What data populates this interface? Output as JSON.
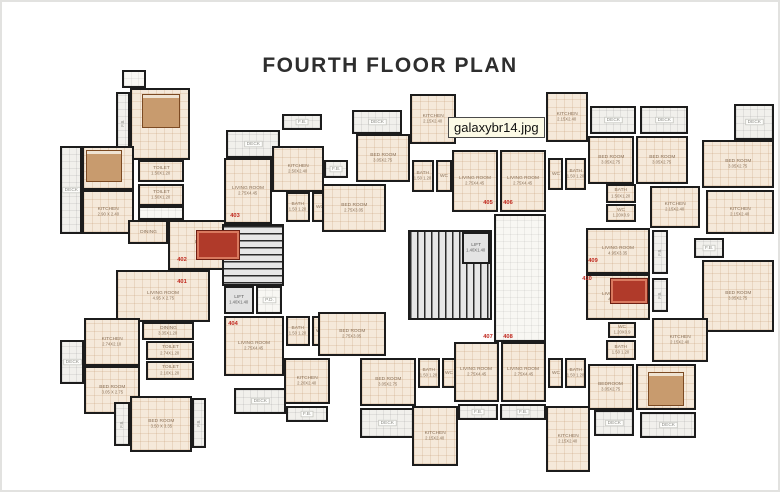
{
  "title": "FOURTH FLOOR PLAN",
  "filename_label": "galaxybr14.jpg",
  "colors": {
    "wall": "#1c1c1c",
    "room_fill": "#f5e9da",
    "deck_fill": "#f1f0ec",
    "stair_fill": "#e6e6e6",
    "flat_number_red": "#c0281e",
    "room_label": "#8a7158",
    "title_color": "#2e2e2e",
    "filename_bg": "#fcfae6"
  },
  "rooms": [
    {
      "id": "left-top-box",
      "label": "",
      "dims": "",
      "x": 122,
      "y": 70,
      "w": 24,
      "h": 18,
      "kind": "lobby"
    },
    {
      "id": "left-bedroom-top",
      "label": "BED ROOM",
      "dims": "3.50 X 3.35",
      "x": 130,
      "y": 88,
      "w": 60,
      "h": 72,
      "kind": "room"
    },
    {
      "id": "left-fb-top",
      "label": "F.B.",
      "dims": "",
      "x": 116,
      "y": 92,
      "w": 14,
      "h": 62,
      "kind": "deck",
      "rot": 1
    },
    {
      "id": "left-bedroom-west",
      "label": "BED ROOM",
      "dims": "2.90 X 2.5",
      "x": 82,
      "y": 146,
      "w": 52,
      "h": 44,
      "kind": "room"
    },
    {
      "id": "left-deck-west",
      "label": "DECK",
      "dims": "",
      "x": 60,
      "y": 146,
      "w": 22,
      "h": 88,
      "kind": "deck"
    },
    {
      "id": "left-kitchen-402",
      "label": "KITCHEN",
      "dims": "2.90 X 2.40",
      "x": 82,
      "y": 190,
      "w": 52,
      "h": 44,
      "kind": "room"
    },
    {
      "id": "left-toilet-1",
      "label": "TOILET",
      "dims": "1.50X1.20",
      "x": 138,
      "y": 160,
      "w": 46,
      "h": 22,
      "kind": "room"
    },
    {
      "id": "left-toilet-2",
      "label": "TOILET",
      "dims": "1.50X1.20",
      "x": 138,
      "y": 184,
      "w": 46,
      "h": 22,
      "kind": "room"
    },
    {
      "id": "left-passage",
      "label": "",
      "dims": "",
      "x": 138,
      "y": 206,
      "w": 46,
      "h": 14,
      "kind": "lobby"
    },
    {
      "id": "left-dining-402",
      "label": "DINING",
      "dims": "",
      "x": 128,
      "y": 220,
      "w": 40,
      "h": 24,
      "kind": "room"
    },
    {
      "id": "left-living-402",
      "label": "LIVINGROOM",
      "dims": "4.95X2.75",
      "x": 168,
      "y": 220,
      "w": 84,
      "h": 50,
      "kind": "room"
    },
    {
      "id": "left-living-401",
      "label": "LIVING ROOM",
      "dims": "4.95 X 2.75",
      "x": 116,
      "y": 270,
      "w": 94,
      "h": 52,
      "kind": "room"
    },
    {
      "id": "left-dining-401",
      "label": "DINING",
      "dims": "3.35X1.20",
      "x": 142,
      "y": 322,
      "w": 52,
      "h": 18,
      "kind": "room"
    },
    {
      "id": "left-kitchen-401",
      "label": "KITCHEN",
      "dims": "2.74X2.10",
      "x": 84,
      "y": 318,
      "w": 56,
      "h": 48,
      "kind": "room"
    },
    {
      "id": "left-toilet-3",
      "label": "TOILET",
      "dims": "2.74X1.20",
      "x": 146,
      "y": 341,
      "w": 48,
      "h": 19,
      "kind": "room"
    },
    {
      "id": "left-toilet-4",
      "label": "TOILET",
      "dims": "2.10X1.20",
      "x": 146,
      "y": 361,
      "w": 48,
      "h": 19,
      "kind": "room"
    },
    {
      "id": "left-deck-south",
      "label": "DECK",
      "dims": "",
      "x": 60,
      "y": 340,
      "w": 24,
      "h": 44,
      "kind": "deck"
    },
    {
      "id": "left-bedroom-south",
      "label": "BED ROOM",
      "dims": "3.05 X 2.75",
      "x": 84,
      "y": 366,
      "w": 56,
      "h": 48,
      "kind": "room"
    },
    {
      "id": "left-bedroom-bottom",
      "label": "BED ROOM",
      "dims": "3.50 X 3.35",
      "x": 130,
      "y": 396,
      "w": 62,
      "h": 56,
      "kind": "room"
    },
    {
      "id": "left-fb-bottom-west",
      "label": "F.B.",
      "dims": "",
      "x": 114,
      "y": 402,
      "w": 16,
      "h": 44,
      "kind": "deck",
      "rot": 1
    },
    {
      "id": "left-fb-bottom-east",
      "label": "F.B.",
      "dims": "",
      "x": 192,
      "y": 398,
      "w": 14,
      "h": 50,
      "kind": "deck",
      "rot": 1
    },
    {
      "id": "cl-deck-top",
      "label": "DECK",
      "dims": "",
      "x": 226,
      "y": 130,
      "w": 54,
      "h": 28,
      "kind": "deck"
    },
    {
      "id": "cl-fb-top",
      "label": "F.B.",
      "dims": "",
      "x": 282,
      "y": 114,
      "w": 40,
      "h": 16,
      "kind": "deck"
    },
    {
      "id": "cl-kitchen-403",
      "label": "KITCHEN",
      "dims": "2.50X2.40",
      "x": 272,
      "y": 146,
      "w": 52,
      "h": 46,
      "kind": "room"
    },
    {
      "id": "cl-living-403",
      "label": "LIVING ROOM",
      "dims": "2.75X4.45",
      "x": 224,
      "y": 158,
      "w": 48,
      "h": 66,
      "kind": "room"
    },
    {
      "id": "cl-bath-403",
      "label": "BATH",
      "dims": "1.50 1.20",
      "x": 286,
      "y": 192,
      "w": 24,
      "h": 30,
      "kind": "room"
    },
    {
      "id": "cl-wc-403",
      "label": "WC",
      "dims": "",
      "x": 312,
      "y": 192,
      "w": 16,
      "h": 30,
      "kind": "room"
    },
    {
      "id": "cl-fb-east",
      "label": "F.B.",
      "dims": "",
      "x": 324,
      "y": 160,
      "w": 24,
      "h": 18,
      "kind": "deck"
    },
    {
      "id": "cl-bedroom-403",
      "label": "BED ROOM",
      "dims": "2.75X3.05",
      "x": 322,
      "y": 184,
      "w": 64,
      "h": 48,
      "kind": "room"
    },
    {
      "id": "cl-stair",
      "label": "",
      "dims": "",
      "x": 222,
      "y": 224,
      "w": 62,
      "h": 62,
      "kind": "stair"
    },
    {
      "id": "cl-lift",
      "label": "LIFT",
      "dims": "1.40X1.40",
      "x": 224,
      "y": 286,
      "w": 30,
      "h": 28,
      "kind": "lift"
    },
    {
      "id": "cl-pd",
      "label": "P.D.",
      "dims": "",
      "x": 256,
      "y": 286,
      "w": 26,
      "h": 28,
      "kind": "lobby"
    },
    {
      "id": "cl-living-404",
      "label": "LIVING ROOM",
      "dims": "2.75X4.45",
      "x": 224,
      "y": 316,
      "w": 60,
      "h": 60,
      "kind": "room"
    },
    {
      "id": "cl-bath-404",
      "label": "BATH",
      "dims": "1.50 1.20",
      "x": 286,
      "y": 316,
      "w": 24,
      "h": 30,
      "kind": "room"
    },
    {
      "id": "cl-wc-404",
      "label": "WC",
      "dims": "",
      "x": 312,
      "y": 316,
      "w": 16,
      "h": 30,
      "kind": "room"
    },
    {
      "id": "cl-kitchen-404",
      "label": "KITCHEN",
      "dims": "2.20X2.40",
      "x": 284,
      "y": 358,
      "w": 46,
      "h": 46,
      "kind": "room"
    },
    {
      "id": "cl-deck-404",
      "label": "DECK",
      "dims": "",
      "x": 234,
      "y": 388,
      "w": 52,
      "h": 26,
      "kind": "deck"
    },
    {
      "id": "cl-fb-404",
      "label": "F.B.",
      "dims": "",
      "x": 286,
      "y": 406,
      "w": 42,
      "h": 16,
      "kind": "deck"
    },
    {
      "id": "cl-bedroom-404",
      "label": "BED ROOM",
      "dims": "2.75X3.05",
      "x": 318,
      "y": 312,
      "w": 68,
      "h": 44,
      "kind": "room"
    },
    {
      "id": "ct-deck",
      "label": "DECK",
      "dims": "",
      "x": 352,
      "y": 110,
      "w": 50,
      "h": 24,
      "kind": "deck"
    },
    {
      "id": "ct-kitchen-west",
      "label": "KITCHEN",
      "dims": "2.15X2.40",
      "x": 410,
      "y": 94,
      "w": 46,
      "h": 50,
      "kind": "room"
    },
    {
      "id": "ct-bedroom-west",
      "label": "BED ROOM",
      "dims": "3.05X2.75",
      "x": 356,
      "y": 134,
      "w": 54,
      "h": 48,
      "kind": "room"
    },
    {
      "id": "ct-bath-west",
      "label": "BATH",
      "dims": "1.50 1.20",
      "x": 412,
      "y": 160,
      "w": 22,
      "h": 32,
      "kind": "room"
    },
    {
      "id": "ct-wc-west",
      "label": "WC",
      "dims": "",
      "x": 436,
      "y": 160,
      "w": 16,
      "h": 32,
      "kind": "room"
    },
    {
      "id": "ct-living-west",
      "label": "LIVING ROOM",
      "dims": "2.75X4.45",
      "x": 452,
      "y": 150,
      "w": 46,
      "h": 62,
      "kind": "room"
    },
    {
      "id": "ct-living-east",
      "label": "LIVING ROOM",
      "dims": "2.75X4.45",
      "x": 500,
      "y": 150,
      "w": 46,
      "h": 62,
      "kind": "room"
    },
    {
      "id": "ct-kitchen-east",
      "label": "KITCHEN",
      "dims": "2.15X2.40",
      "x": 546,
      "y": 92,
      "w": 42,
      "h": 50,
      "kind": "room"
    },
    {
      "id": "ct-wc-east",
      "label": "WC",
      "dims": "",
      "x": 548,
      "y": 158,
      "w": 15,
      "h": 32,
      "kind": "room"
    },
    {
      "id": "ct-bath-east",
      "label": "BATH",
      "dims": "1.50 1.20",
      "x": 565,
      "y": 158,
      "w": 21,
      "h": 32,
      "kind": "room"
    },
    {
      "id": "tr-deck-1",
      "label": "DECK",
      "dims": "",
      "x": 590,
      "y": 106,
      "w": 46,
      "h": 28,
      "kind": "deck"
    },
    {
      "id": "tr-deck-2",
      "label": "DECK",
      "dims": "",
      "x": 640,
      "y": 106,
      "w": 48,
      "h": 28,
      "kind": "deck"
    },
    {
      "id": "tr-bedroom-west",
      "label": "BED ROOM",
      "dims": "3.05X2.75",
      "x": 588,
      "y": 136,
      "w": 46,
      "h": 48,
      "kind": "room"
    },
    {
      "id": "tr-bedroom-east",
      "label": "BED ROOM",
      "dims": "3.05X2.75",
      "x": 636,
      "y": 136,
      "w": 52,
      "h": 48,
      "kind": "room"
    },
    {
      "id": "tr-bath",
      "label": "BATH",
      "dims": "1.50X1.20",
      "x": 606,
      "y": 184,
      "w": 30,
      "h": 19,
      "kind": "room"
    },
    {
      "id": "tr-wc",
      "label": "WC",
      "dims": "1.20X0.9",
      "x": 606,
      "y": 204,
      "w": 30,
      "h": 18,
      "kind": "room"
    },
    {
      "id": "tr-kitchen",
      "label": "KITCHEN",
      "dims": "2.15X2.40",
      "x": 650,
      "y": 186,
      "w": 50,
      "h": 42,
      "kind": "room"
    },
    {
      "id": "tr-deck-far",
      "label": "DECK",
      "dims": "",
      "x": 734,
      "y": 104,
      "w": 40,
      "h": 36,
      "kind": "deck"
    },
    {
      "id": "tr-bedroom-far",
      "label": "BED ROOM",
      "dims": "3.05X2.75",
      "x": 702,
      "y": 140,
      "w": 72,
      "h": 48,
      "kind": "room"
    },
    {
      "id": "tr-kitchen-far",
      "label": "KITCHEN",
      "dims": "2.15X2.40",
      "x": 706,
      "y": 190,
      "w": 68,
      "h": 44,
      "kind": "room"
    },
    {
      "id": "tr-fb",
      "label": "F.B.",
      "dims": "",
      "x": 694,
      "y": 238,
      "w": 30,
      "h": 20,
      "kind": "deck"
    },
    {
      "id": "rw-living-409",
      "label": "LIVING ROOM",
      "dims": "4.95X3.35",
      "x": 586,
      "y": 228,
      "w": 64,
      "h": 46,
      "kind": "room"
    },
    {
      "id": "rw-fb-409",
      "label": "F.B.",
      "dims": "",
      "x": 652,
      "y": 230,
      "w": 16,
      "h": 44,
      "kind": "deck",
      "rot": 1
    },
    {
      "id": "rw-living-410",
      "label": "LIVING ROOM",
      "dims": "4.95X3.05",
      "x": 586,
      "y": 274,
      "w": 64,
      "h": 46,
      "kind": "room"
    },
    {
      "id": "rw-fb-410",
      "label": "F.B.",
      "dims": "",
      "x": 652,
      "y": 278,
      "w": 16,
      "h": 34,
      "kind": "deck",
      "rot": 1
    },
    {
      "id": "rw-bedroom-far",
      "label": "BED ROOM",
      "dims": "3.05X2.75",
      "x": 702,
      "y": 260,
      "w": 72,
      "h": 72,
      "kind": "room"
    },
    {
      "id": "rw-wc-410",
      "label": "WC",
      "dims": "1.20X0.9",
      "x": 608,
      "y": 322,
      "w": 28,
      "h": 16,
      "kind": "room"
    },
    {
      "id": "rw-bath-410",
      "label": "BATH",
      "dims": "1.50 1.20",
      "x": 606,
      "y": 340,
      "w": 30,
      "h": 20,
      "kind": "room"
    },
    {
      "id": "rw-kitchen-410",
      "label": "KITCHEN",
      "dims": "2.15X2.40",
      "x": 652,
      "y": 318,
      "w": 56,
      "h": 44,
      "kind": "room"
    },
    {
      "id": "rw-bedroom-410",
      "label": "BED ROOM",
      "dims": "3.05X2.75",
      "x": 636,
      "y": 364,
      "w": 60,
      "h": 46,
      "kind": "room"
    },
    {
      "id": "rw-deck-1",
      "label": "DECK",
      "dims": "",
      "x": 594,
      "y": 410,
      "w": 40,
      "h": 26,
      "kind": "deck"
    },
    {
      "id": "rw-deck-2",
      "label": "DECK",
      "dims": "",
      "x": 640,
      "y": 412,
      "w": 56,
      "h": 26,
      "kind": "deck"
    },
    {
      "id": "cb-bedroom-1",
      "label": "BED ROOM",
      "dims": "3.05X2.75",
      "x": 360,
      "y": 358,
      "w": 56,
      "h": 48,
      "kind": "room"
    },
    {
      "id": "cb-bath-west",
      "label": "BATH",
      "dims": "1.50 1.20",
      "x": 418,
      "y": 358,
      "w": 22,
      "h": 30,
      "kind": "room"
    },
    {
      "id": "cb-wc-west",
      "label": "WC",
      "dims": "",
      "x": 442,
      "y": 358,
      "w": 14,
      "h": 30,
      "kind": "room"
    },
    {
      "id": "cb-living-west",
      "label": "LIVING ROOM",
      "dims": "2.75X4.45",
      "x": 454,
      "y": 342,
      "w": 45,
      "h": 60,
      "kind": "room"
    },
    {
      "id": "cb-living-east",
      "label": "LIVING ROOM",
      "dims": "2.75X4.45",
      "x": 501,
      "y": 342,
      "w": 45,
      "h": 60,
      "kind": "room"
    },
    {
      "id": "cb-deck",
      "label": "DECK",
      "dims": "",
      "x": 360,
      "y": 408,
      "w": 54,
      "h": 30,
      "kind": "deck"
    },
    {
      "id": "cb-kitchen-west",
      "label": "KITCHEN",
      "dims": "2.15X2.40",
      "x": 412,
      "y": 406,
      "w": 46,
      "h": 60,
      "kind": "room"
    },
    {
      "id": "cb-fb-1",
      "label": "F.B.",
      "dims": "",
      "x": 458,
      "y": 404,
      "w": 40,
      "h": 16,
      "kind": "deck"
    },
    {
      "id": "cb-fb-2",
      "label": "F.B.",
      "dims": "",
      "x": 500,
      "y": 404,
      "w": 46,
      "h": 16,
      "kind": "deck"
    },
    {
      "id": "cb-kitchen-east",
      "label": "KITCHEN",
      "dims": "2.15X2.40",
      "x": 546,
      "y": 406,
      "w": 44,
      "h": 66,
      "kind": "room"
    },
    {
      "id": "cb-wc-east",
      "label": "WC",
      "dims": "",
      "x": 548,
      "y": 358,
      "w": 15,
      "h": 30,
      "kind": "room"
    },
    {
      "id": "cb-bath-east",
      "label": "BATH",
      "dims": "1.50 1.20",
      "x": 565,
      "y": 358,
      "w": 21,
      "h": 30,
      "kind": "room"
    },
    {
      "id": "cb-bedroom-east",
      "label": "BEDROOM",
      "dims": "3.05X2.75",
      "x": 588,
      "y": 364,
      "w": 46,
      "h": 46,
      "kind": "room"
    },
    {
      "id": "core-stair",
      "label": "",
      "dims": "",
      "x": 408,
      "y": 230,
      "w": 84,
      "h": 90,
      "kind": "stair",
      "dir": "v"
    },
    {
      "id": "core-lift",
      "label": "LIFT",
      "dims": "1.40X1.40",
      "x": 462,
      "y": 232,
      "w": 28,
      "h": 32,
      "kind": "lift"
    },
    {
      "id": "core-lobby",
      "label": "",
      "dims": "",
      "x": 494,
      "y": 214,
      "w": 52,
      "h": 128,
      "kind": "lobby"
    }
  ],
  "flat_numbers": [
    {
      "num": "401",
      "x": 177,
      "y": 279
    },
    {
      "num": "402",
      "x": 177,
      "y": 257
    },
    {
      "num": "403",
      "x": 230,
      "y": 213
    },
    {
      "num": "404",
      "x": 228,
      "y": 321
    },
    {
      "num": "405",
      "x": 483,
      "y": 200
    },
    {
      "num": "406",
      "x": 503,
      "y": 200
    },
    {
      "num": "407",
      "x": 483,
      "y": 334
    },
    {
      "num": "408",
      "x": 503,
      "y": 334
    },
    {
      "num": "409",
      "x": 588,
      "y": 258
    },
    {
      "num": "410",
      "x": 582,
      "y": 276
    }
  ],
  "furniture": [
    {
      "type": "bed",
      "x": 142,
      "y": 94,
      "w": 38,
      "h": 34
    },
    {
      "type": "bed",
      "x": 86,
      "y": 150,
      "w": 36,
      "h": 32
    },
    {
      "type": "rug",
      "x": 196,
      "y": 230,
      "w": 44,
      "h": 30
    },
    {
      "type": "rug",
      "x": 610,
      "y": 278,
      "w": 38,
      "h": 26
    },
    {
      "type": "bed",
      "x": 648,
      "y": 372,
      "w": 36,
      "h": 34
    }
  ]
}
